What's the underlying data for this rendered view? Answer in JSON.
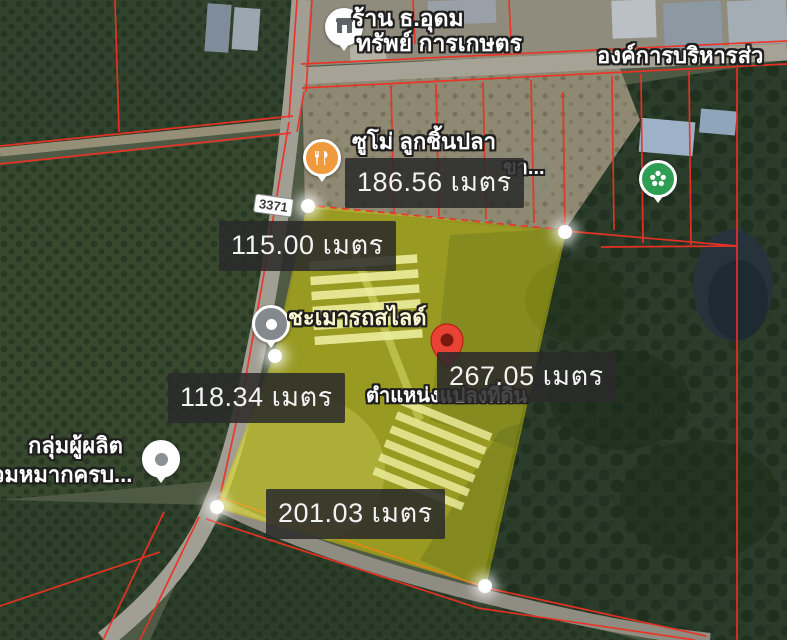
{
  "map": {
    "road_shield": "3371",
    "pois": {
      "shop_top": {
        "line1": "ร้าน ธ.อุดม",
        "line2": "ทรัพย์ การเกษตร"
      },
      "admin_org": "องค์การบริหารส่ว",
      "restaurant": "ซูโม่ ลูกชิ้นปลา",
      "kha_truncated": "ขา...",
      "car_slide": "ชะเมารถสไลด์",
      "producer_group": {
        "line1": "กลุ่มผู้ผลิต",
        "line2": "วมหมากครบ..."
      }
    },
    "plot": {
      "caption": "ตำแหน่งแปลงที่ดิน",
      "measurements": {
        "top": "186.56 เมตร",
        "upper_left": "115.00 เมตร",
        "right": "267.05 เมตร",
        "left": "118.34 เมตร",
        "bottom": "201.03 เมตร"
      }
    },
    "colors": {
      "parcel_line": "#ee3124",
      "plot_fill": "#e3da00",
      "plot_stroke": "#d6cc00",
      "pin_red": "#e94335",
      "pin_orange": "#f09a3e",
      "pin_green": "#2f9e55",
      "pin_gray": "#84898d",
      "label_bg": "#2b2b2b",
      "label_text": "#f2f2f2"
    }
  }
}
